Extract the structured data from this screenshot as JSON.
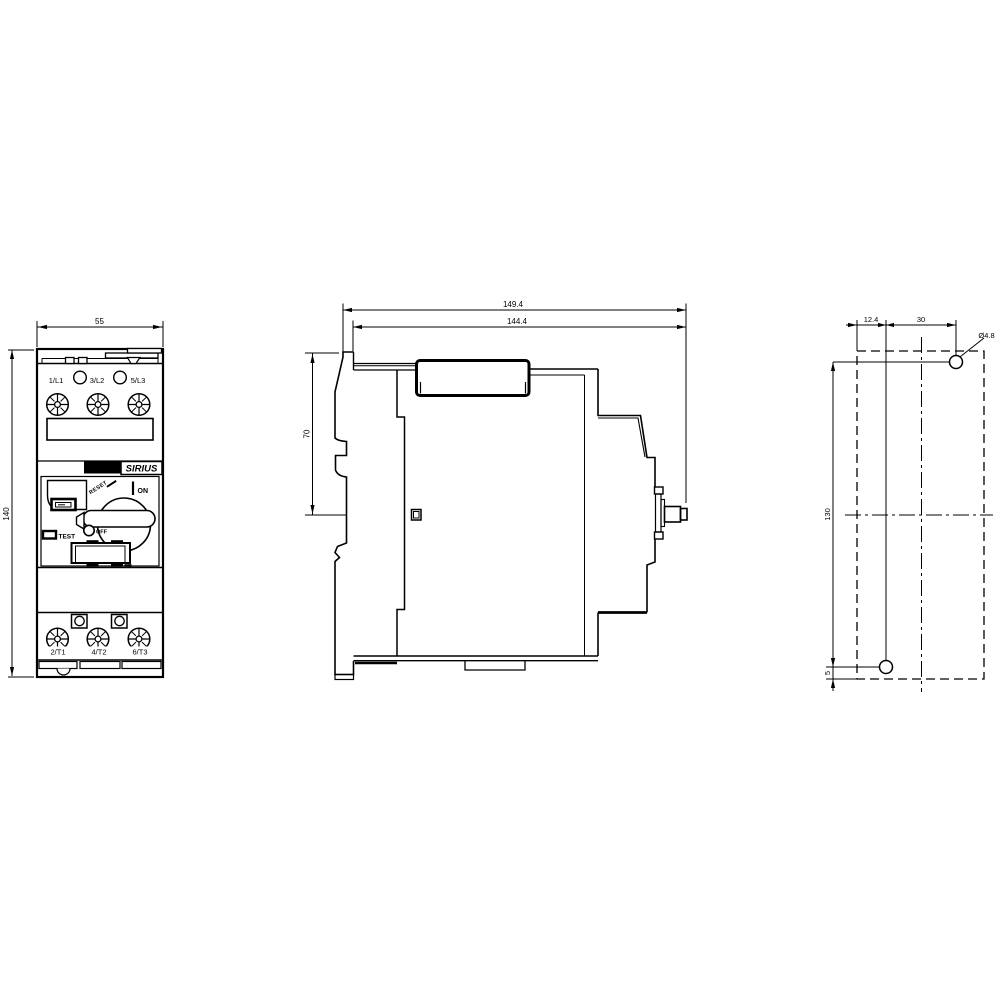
{
  "views": {
    "front": {
      "dim_width": "55",
      "dim_height": "140",
      "top_terminals": [
        "1/L1",
        "3/L2",
        "5/L3"
      ],
      "bottom_terminals": [
        "2/T1",
        "4/T2",
        "6/T3"
      ],
      "badge": "SIEMENS",
      "brand": "SIRIUS",
      "switch": {
        "on": "ON",
        "off": "OFF",
        "test": "TEST",
        "reset": "RESET"
      }
    },
    "side": {
      "dim_depth_total": "149.4",
      "dim_depth_body": "144.4",
      "dim_din_clip": "70"
    },
    "mounting": {
      "dim_hole_inset_x": "12.4",
      "dim_hole_span_x": "30",
      "dim_hole_span_y": "130",
      "dim_bottom_offset": "5",
      "hole_diameter": "Ø4.8"
    }
  },
  "colors": {
    "line": "#000000",
    "background": "#ffffff"
  }
}
